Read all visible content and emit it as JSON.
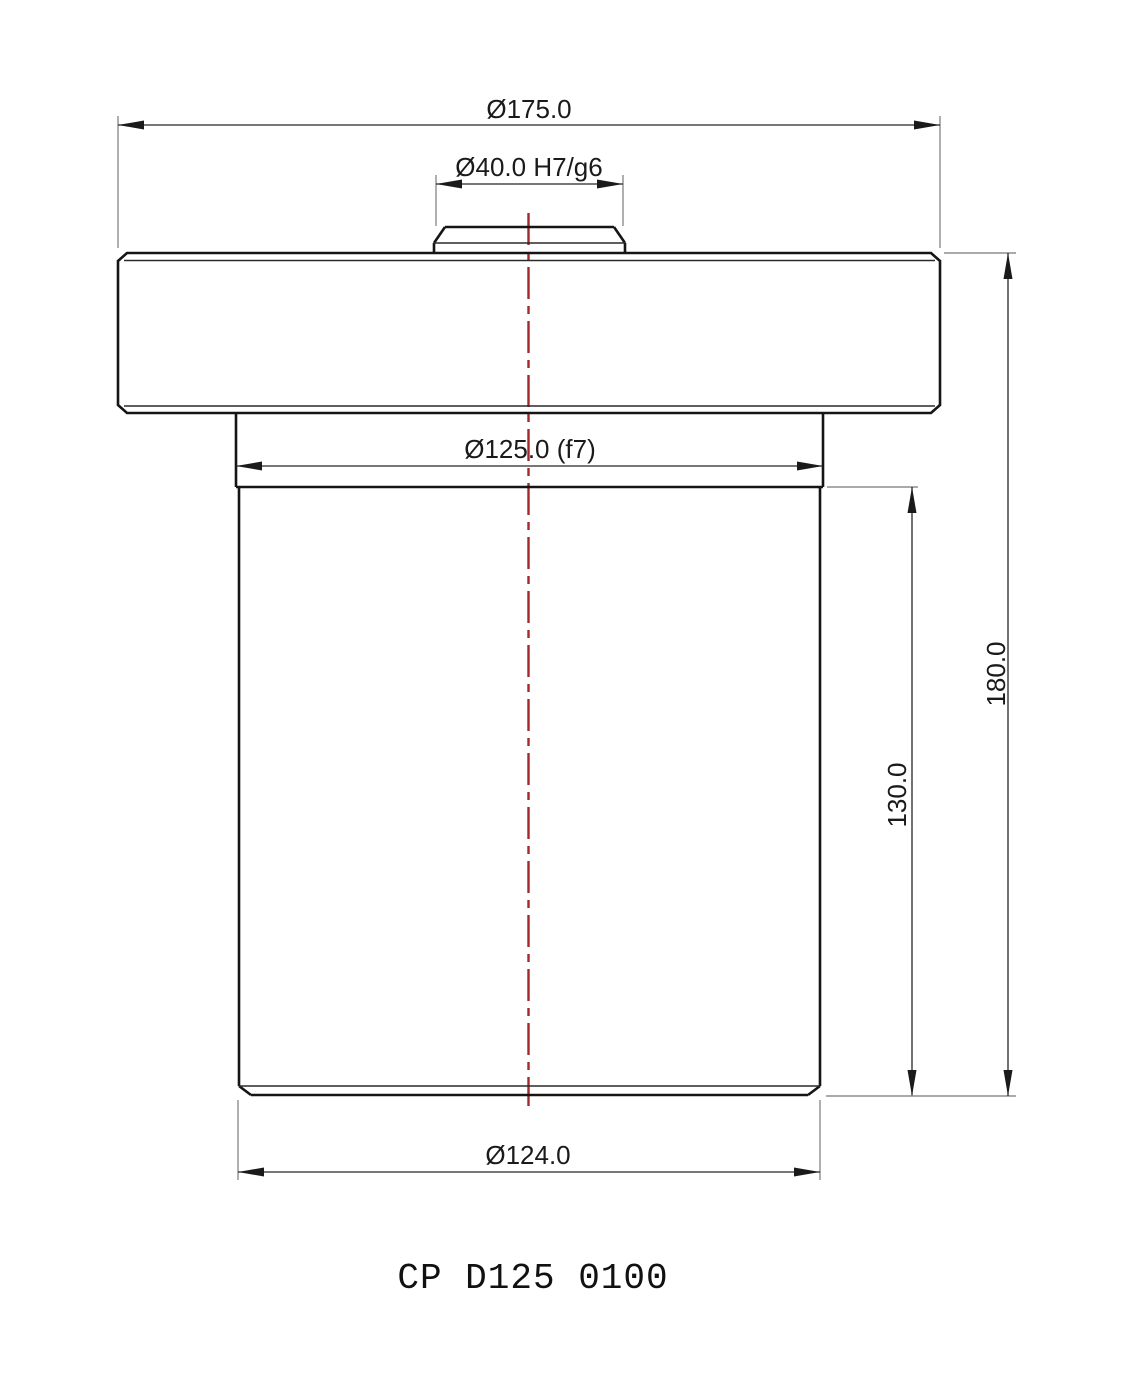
{
  "drawing": {
    "title": "CP D125 0100",
    "dimensions": {
      "flange_diameter": "Ø175.0",
      "boss_fit": "Ø40.0 H7/g6",
      "neck_fit": "Ø125.0 (f7)",
      "body_diameter": "Ø124.0",
      "body_height": "130.0",
      "overall_height": "180.0"
    },
    "colors": {
      "centerline_red": "#a2282b"
    }
  }
}
